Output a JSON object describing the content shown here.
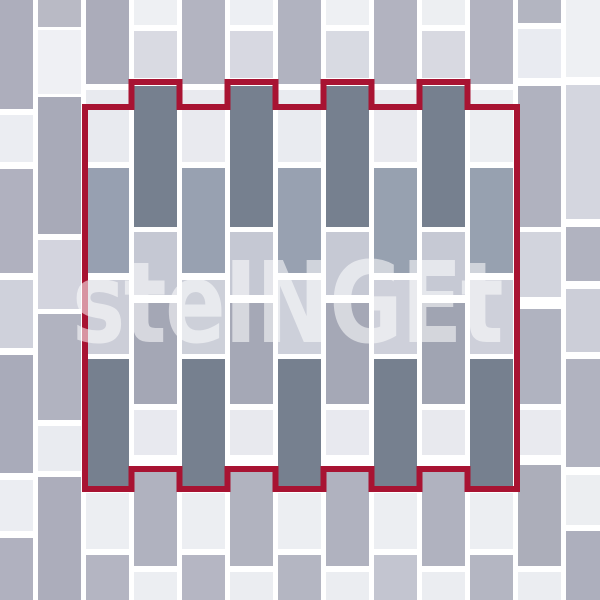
{
  "canvas": {
    "width": 600,
    "height": 600,
    "background": "#ffffff",
    "joint_color": "#ffffff"
  },
  "watermark": {
    "text": "steINGEt",
    "color": "rgba(255,255,255,0.55)"
  },
  "pattern_outline": {
    "color": "#a81332",
    "stroke_width": 6,
    "points": "85,107 131.5,107 131.5,82 179.5,82 179.5,107 227.5,107 227.5,82 275.5,82 275.5,107 323.5,107 323.5,82 371.5,82 371.5,107 419.5,107 419.5,82 467.5,82 467.5,107 517,107 517,489 467.5,489 467.5,469 419.5,469 419.5,489 371.5,489 371.5,469 323.5,469 323.5,489 275.5,489 275.5,469 227.5,469 227.5,489 179.5,489 179.5,469 131.5,469 131.5,489 85,489"
  },
  "palette": {
    "white_tile": "#eceef2",
    "light_gray_tile": "#ced0da",
    "medium_gray_tile": "#b0b2bf",
    "blue_gray_tile": "#97a0b1",
    "dark_gray_tile": "#76808f",
    "repeat_outline_red": "#a81332"
  },
  "tile_columns": [
    {
      "x": -10,
      "width": 43,
      "tiles": [
        [
          0,
          109,
          "#adaebc"
        ],
        [
          115,
          162,
          "#ebedf2"
        ],
        [
          169,
          273,
          "#b0b1bf"
        ],
        [
          280,
          348,
          "#cfd1db"
        ],
        [
          355,
          473,
          "#a9abba"
        ],
        [
          480,
          531,
          "#ebedf2"
        ],
        [
          538,
          600,
          "#b0b1bf"
        ]
      ]
    },
    {
      "x": 38,
      "width": 43,
      "tiles": [
        [
          0,
          27,
          "#b9bac5"
        ],
        [
          30,
          94,
          "#eff0f4"
        ],
        [
          97,
          234,
          "#a8aab8"
        ],
        [
          240,
          309,
          "#d3d4de"
        ],
        [
          314,
          420,
          "#b1b3c0"
        ],
        [
          426,
          471,
          "#e9ebf0"
        ],
        [
          477,
          600,
          "#acadbb"
        ]
      ]
    },
    {
      "x": 86,
      "width": 43,
      "tiles": [
        [
          0,
          84,
          "#abacba"
        ],
        [
          90,
          162,
          "#e8eaef"
        ],
        [
          168,
          273,
          "#97a0b1"
        ],
        [
          280,
          354,
          "#ccced8"
        ],
        [
          359,
          486,
          "#76808f"
        ],
        [
          493,
          549,
          "#eceef2"
        ],
        [
          555,
          600,
          "#b4b5c2"
        ]
      ]
    },
    {
      "x": 134,
      "width": 43,
      "tiles": [
        [
          0,
          25,
          "#eef0f3"
        ],
        [
          31,
          78,
          "#d9dae2"
        ],
        [
          86,
          227,
          "#76808f"
        ],
        [
          232,
          295,
          "#c5c8d3"
        ],
        [
          303,
          404,
          "#a4a7b5"
        ],
        [
          410,
          455,
          "#e8e9ef"
        ],
        [
          470,
          566,
          "#b0b2bf"
        ],
        [
          572,
          600,
          "#eceef2"
        ]
      ]
    },
    {
      "x": 182,
      "width": 43,
      "tiles": [
        [
          0,
          84,
          "#b3b4c1"
        ],
        [
          90,
          162,
          "#e9eaef"
        ],
        [
          168,
          273,
          "#98a1b1"
        ],
        [
          280,
          354,
          "#cdd0d9"
        ],
        [
          359,
          486,
          "#76808f"
        ],
        [
          493,
          549,
          "#eceef2"
        ],
        [
          555,
          600,
          "#b5b6c3"
        ]
      ]
    },
    {
      "x": 230,
      "width": 43,
      "tiles": [
        [
          0,
          25,
          "#edeff3"
        ],
        [
          31,
          78,
          "#d7d8e1"
        ],
        [
          86,
          227,
          "#76808f"
        ],
        [
          232,
          295,
          "#c5c8d3"
        ],
        [
          303,
          404,
          "#a5a8b6"
        ],
        [
          410,
          455,
          "#e8e9ee"
        ],
        [
          470,
          566,
          "#b1b3bf"
        ],
        [
          572,
          600,
          "#ebedf1"
        ]
      ]
    },
    {
      "x": 278,
      "width": 43,
      "tiles": [
        [
          0,
          84,
          "#b1b3c0"
        ],
        [
          90,
          162,
          "#e9ebf0"
        ],
        [
          168,
          273,
          "#98a1b1"
        ],
        [
          280,
          354,
          "#cdd0da"
        ],
        [
          359,
          486,
          "#76808f"
        ],
        [
          493,
          549,
          "#eceef2"
        ],
        [
          555,
          600,
          "#b4b6c2"
        ]
      ]
    },
    {
      "x": 326,
      "width": 43,
      "tiles": [
        [
          0,
          25,
          "#eef0f3"
        ],
        [
          31,
          78,
          "#d8dae2"
        ],
        [
          86,
          227,
          "#76808f"
        ],
        [
          232,
          295,
          "#c6c9d4"
        ],
        [
          303,
          404,
          "#a5a8b6"
        ],
        [
          410,
          455,
          "#e8e9ef"
        ],
        [
          470,
          566,
          "#b0b2bf"
        ],
        [
          572,
          600,
          "#ebedf1"
        ]
      ]
    },
    {
      "x": 374,
      "width": 43,
      "tiles": [
        [
          0,
          84,
          "#b2b3c0"
        ],
        [
          90,
          162,
          "#e9eaef"
        ],
        [
          168,
          273,
          "#97a1b0"
        ],
        [
          280,
          354,
          "#ced0da"
        ],
        [
          359,
          486,
          "#76808f"
        ],
        [
          493,
          549,
          "#eceef2"
        ],
        [
          555,
          600,
          "#c3c5d0"
        ]
      ]
    },
    {
      "x": 422,
      "width": 43,
      "tiles": [
        [
          0,
          25,
          "#edeff2"
        ],
        [
          31,
          78,
          "#d8d9e1"
        ],
        [
          86,
          227,
          "#76808f"
        ],
        [
          232,
          295,
          "#c6c9d4"
        ],
        [
          303,
          404,
          "#a0a4b2"
        ],
        [
          410,
          455,
          "#e8e9ee"
        ],
        [
          470,
          566,
          "#b0b2bf"
        ],
        [
          572,
          600,
          "#ebedf1"
        ]
      ]
    },
    {
      "x": 470,
      "width": 43,
      "tiles": [
        [
          0,
          84,
          "#b2b3c0"
        ],
        [
          90,
          162,
          "#eceef2"
        ],
        [
          168,
          273,
          "#97a1b0"
        ],
        [
          280,
          354,
          "#ced0da"
        ],
        [
          359,
          486,
          "#76808f"
        ],
        [
          493,
          549,
          "#eceef2"
        ],
        [
          555,
          600,
          "#b4b6c2"
        ]
      ]
    },
    {
      "x": 518,
      "width": 43,
      "tiles": [
        [
          0,
          23,
          "#b3b5c1"
        ],
        [
          29,
          78,
          "#e9ebf1"
        ],
        [
          86,
          227,
          "#b0b2bf"
        ],
        [
          232,
          297,
          "#d2d4dd"
        ],
        [
          309,
          404,
          "#b0b3c0"
        ],
        [
          410,
          455,
          "#e9eaef"
        ],
        [
          465,
          566,
          "#acaeba"
        ],
        [
          572,
          600,
          "#ebedf1"
        ]
      ]
    },
    {
      "x": 566,
      "width": 43,
      "tiles": [
        [
          0,
          77,
          "#eef0f3"
        ],
        [
          85,
          219,
          "#d4d6df"
        ],
        [
          227,
          281,
          "#b1b3c0"
        ],
        [
          289,
          352,
          "#ccced8"
        ],
        [
          359,
          467,
          "#b1b3c0"
        ],
        [
          475,
          525,
          "#eceef1"
        ],
        [
          531,
          600,
          "#adafbd"
        ]
      ]
    }
  ]
}
